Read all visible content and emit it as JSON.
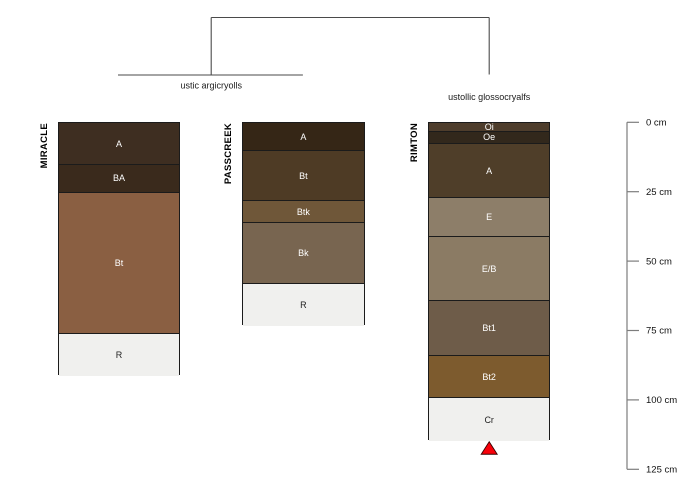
{
  "chart_data": {
    "type": "bar",
    "variant": "soil-profile-sketches-with-dendrogram",
    "title": "",
    "ylabel": "depth (cm)",
    "ylim": [
      0,
      125
    ],
    "grid": false,
    "depth_axis": {
      "unit": "cm",
      "side": "right",
      "ticks": [
        {
          "value": 0,
          "label": "0 cm"
        },
        {
          "value": 25,
          "label": "25 cm"
        },
        {
          "value": 50,
          "label": "50 cm"
        },
        {
          "value": 75,
          "label": "75 cm"
        },
        {
          "value": 100,
          "label": "100 cm"
        },
        {
          "value": 125,
          "label": "125 cm"
        }
      ]
    },
    "profiles": [
      {
        "name": "MIRACLE",
        "horizons": [
          {
            "name": "A",
            "top": 0,
            "bottom": 15,
            "color": "#3E2E21"
          },
          {
            "name": "BA",
            "top": 15,
            "bottom": 25,
            "color": "#3A2A1C"
          },
          {
            "name": "Bt",
            "top": 25,
            "bottom": 76,
            "color": "#8A5F42"
          },
          {
            "name": "R",
            "top": 76,
            "bottom": 91,
            "color": "#F0F0EE"
          }
        ]
      },
      {
        "name": "PASSCREEK",
        "horizons": [
          {
            "name": "A",
            "top": 0,
            "bottom": 10,
            "color": "#352616"
          },
          {
            "name": "Bt",
            "top": 10,
            "bottom": 28,
            "color": "#4E3B25"
          },
          {
            "name": "Btk",
            "top": 28,
            "bottom": 36,
            "color": "#6F5739"
          },
          {
            "name": "Bk",
            "top": 36,
            "bottom": 58,
            "color": "#786550"
          },
          {
            "name": "R",
            "top": 58,
            "bottom": 73,
            "color": "#F0F0EE"
          }
        ]
      },
      {
        "name": "RIMTON",
        "horizons": [
          {
            "name": "Oi",
            "top": 0,
            "bottom": 3,
            "color": "#4E3D2C"
          },
          {
            "name": "Oe",
            "top": 3,
            "bottom": 7.5,
            "color": "#32281C"
          },
          {
            "name": "A",
            "top": 7.5,
            "bottom": 27,
            "color": "#4F3E29"
          },
          {
            "name": "E",
            "top": 27,
            "bottom": 41,
            "color": "#8D7E69"
          },
          {
            "name": "E/B",
            "top": 41,
            "bottom": 64,
            "color": "#8B7B64"
          },
          {
            "name": "Bt1",
            "top": 64,
            "bottom": 84,
            "color": "#6E5C49"
          },
          {
            "name": "Bt2",
            "top": 84,
            "bottom": 99,
            "color": "#7D5B2E"
          },
          {
            "name": "Cr",
            "top": 99,
            "bottom": 114.5,
            "color": "#F0F0EE"
          }
        ]
      }
    ],
    "dendrogram": {
      "groups": [
        {
          "label": "ustic argicryolls",
          "members": [
            "MIRACLE",
            "PASSCREEK"
          ]
        },
        {
          "label": "ustollic glossocryalfs",
          "members": [
            "RIMTON"
          ]
        }
      ]
    },
    "marker": {
      "shape": "triangle-up",
      "fill_color": "#F80009",
      "outline_color": "#3a0000",
      "below_profile": "RIMTON"
    },
    "style_colors": {
      "dendrogram_line": "#4a4a4a",
      "axis_line": "#7d7d7d",
      "horizon_border": "#1b1b1b",
      "light_horizon_text": "#222222",
      "dark_horizon_text": "#ffffff"
    }
  }
}
